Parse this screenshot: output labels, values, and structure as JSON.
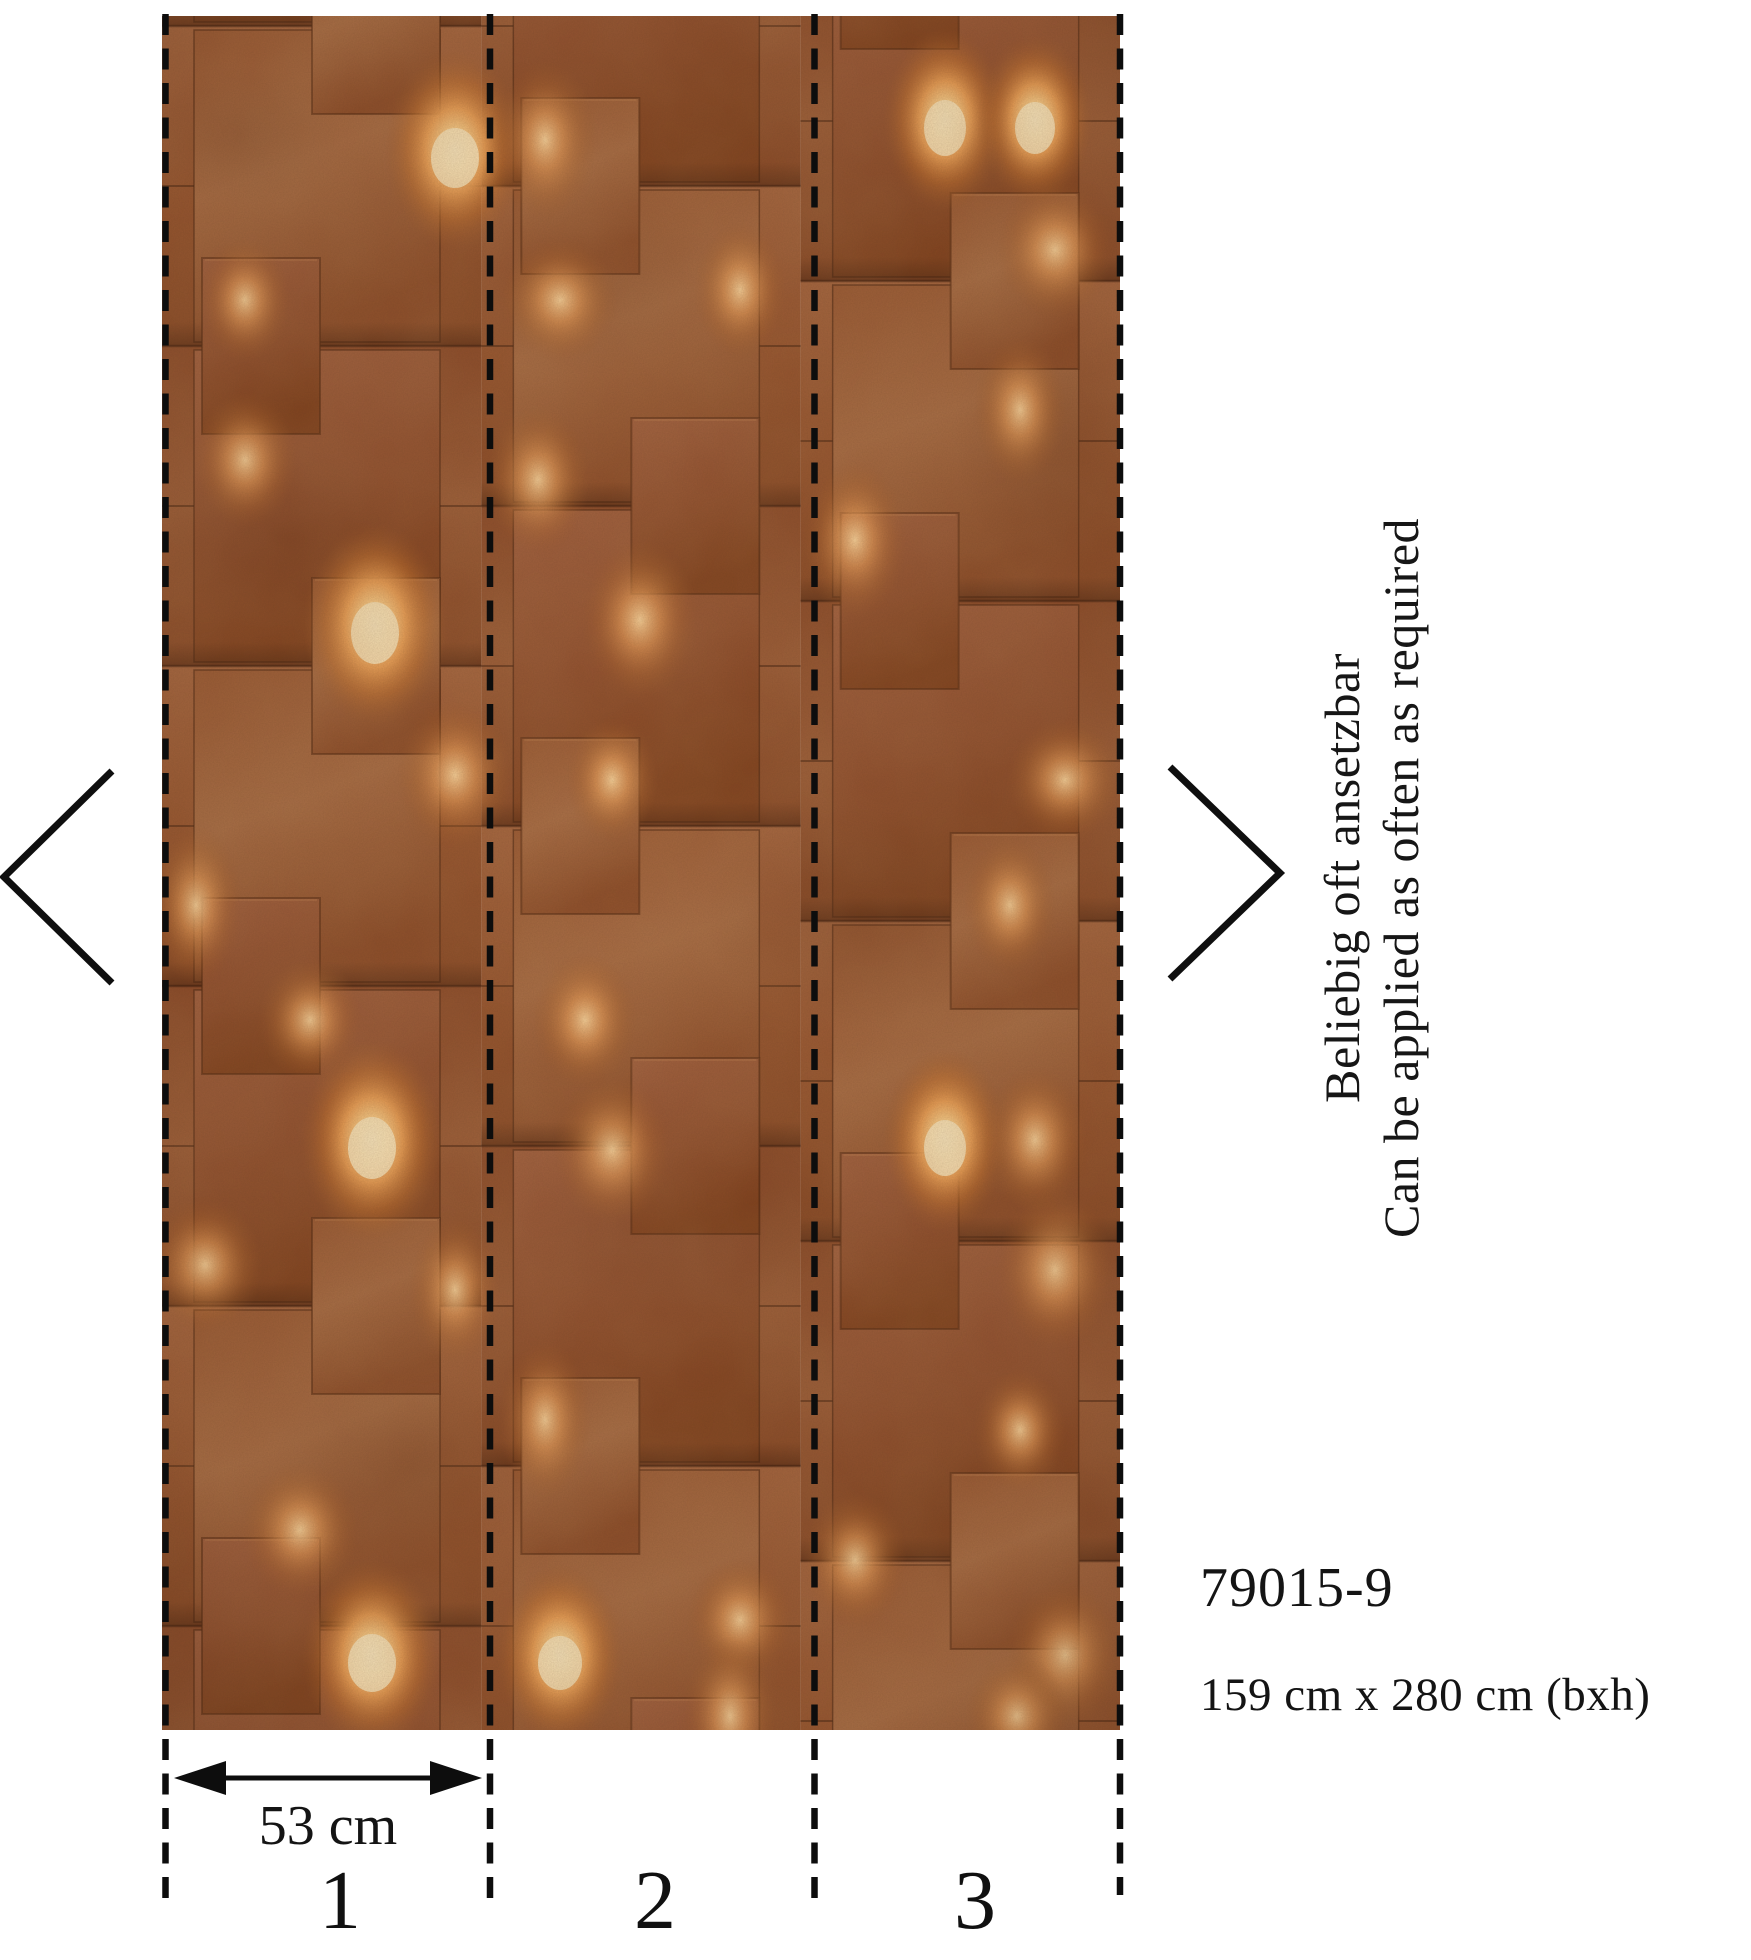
{
  "artwork": {
    "description": "rust concrete panel wallpaper with warm recessed lighting",
    "base_color": "#99582f",
    "glow_color": "#ffd592",
    "seam_color": "#3f1e0c",
    "line_color": "#0d0d0d"
  },
  "nav": {
    "prev_label": "previous pattern view",
    "next_label": "next pattern view"
  },
  "annotation": {
    "line1": "Beliebig oft ansetzbar",
    "line2": "Can be applied as often as required"
  },
  "product": {
    "code": "79015-9",
    "dimensions": "159 cm x 280 cm (bxh)"
  },
  "measurement": {
    "label": "53 cm"
  },
  "strips": {
    "labels": [
      "1",
      "2",
      "3"
    ]
  }
}
